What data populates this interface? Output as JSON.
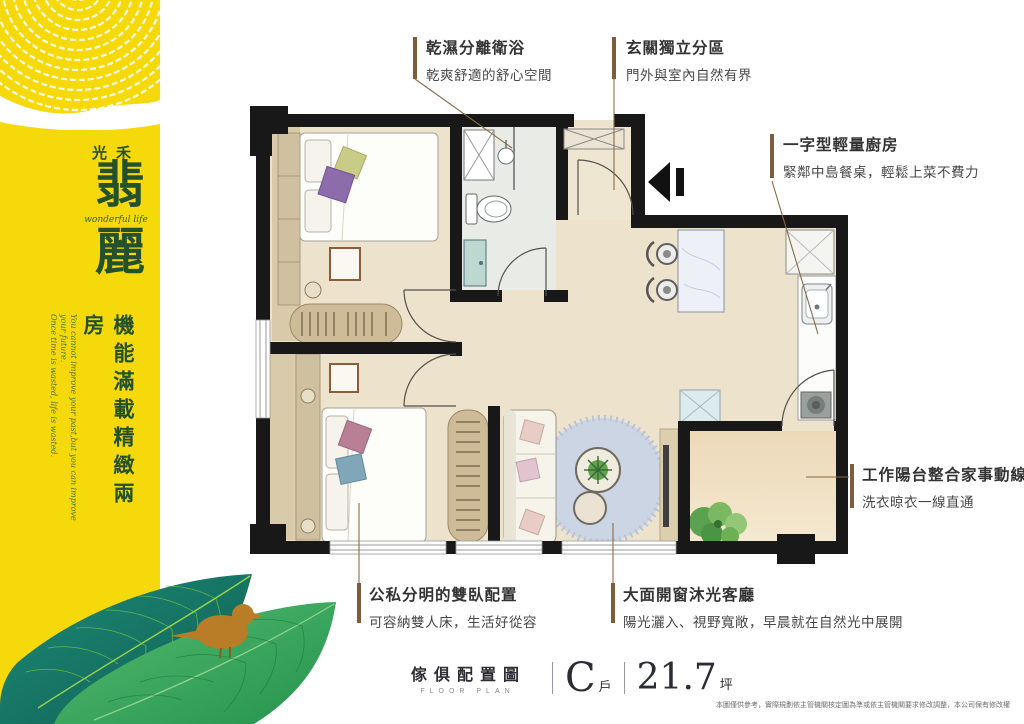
{
  "brand": {
    "name_small": "光禾",
    "name_large_1": "翡",
    "name_large_2": "麗",
    "name_english": "wonderful life",
    "tagline": "機能滿載精緻兩房",
    "tagline_english_line1": "You cannot improve your past,but you can improve your future.",
    "tagline_english_line2": "Once time is wasted, life is wasted."
  },
  "callouts": {
    "bathroom": {
      "title": "乾濕分離衛浴",
      "desc": "乾爽舒適的舒心空間"
    },
    "entry": {
      "title": "玄關獨立分區",
      "desc": "門外與室內自然有界"
    },
    "kitchen": {
      "title": "一字型輕量廚房",
      "desc": "緊鄰中島餐桌，輕鬆上菜不費力"
    },
    "balcony": {
      "title": "工作陽台整合家事動線",
      "desc": "洗衣晾衣一線直通"
    },
    "bedrooms": {
      "title": "公私分明的雙臥配置",
      "desc": "可容納雙人床，生活好從容"
    },
    "living": {
      "title": "大面開窗沐光客廳",
      "desc": "陽光灑入、視野寬敞，早晨就在自然光中展開"
    }
  },
  "footer": {
    "label_zh": "傢俱配置圖",
    "label_en": "FLOOR PLAN",
    "unit_letter": "C",
    "unit_suffix": "戶",
    "area_value": "21.7",
    "area_unit": "坪",
    "disclaimer": "本圖僅供參考，實際規劃依主管機關核定圖為準或依主管機關要求修改調整，本公司保有修改權"
  },
  "colors": {
    "banner_yellow": "#f6d90a",
    "brand_green": "#24512b",
    "callout_accent": "#8a6b46",
    "wall_black": "#181818",
    "floor_beige": "#ede2cc",
    "bathroom_floor": "#e9ece6",
    "rug_blue": "#cbd5e3",
    "leaf_teal": "#17756a",
    "leaf_green": "#2f9e57",
    "bird_orange": "#b87d26"
  }
}
